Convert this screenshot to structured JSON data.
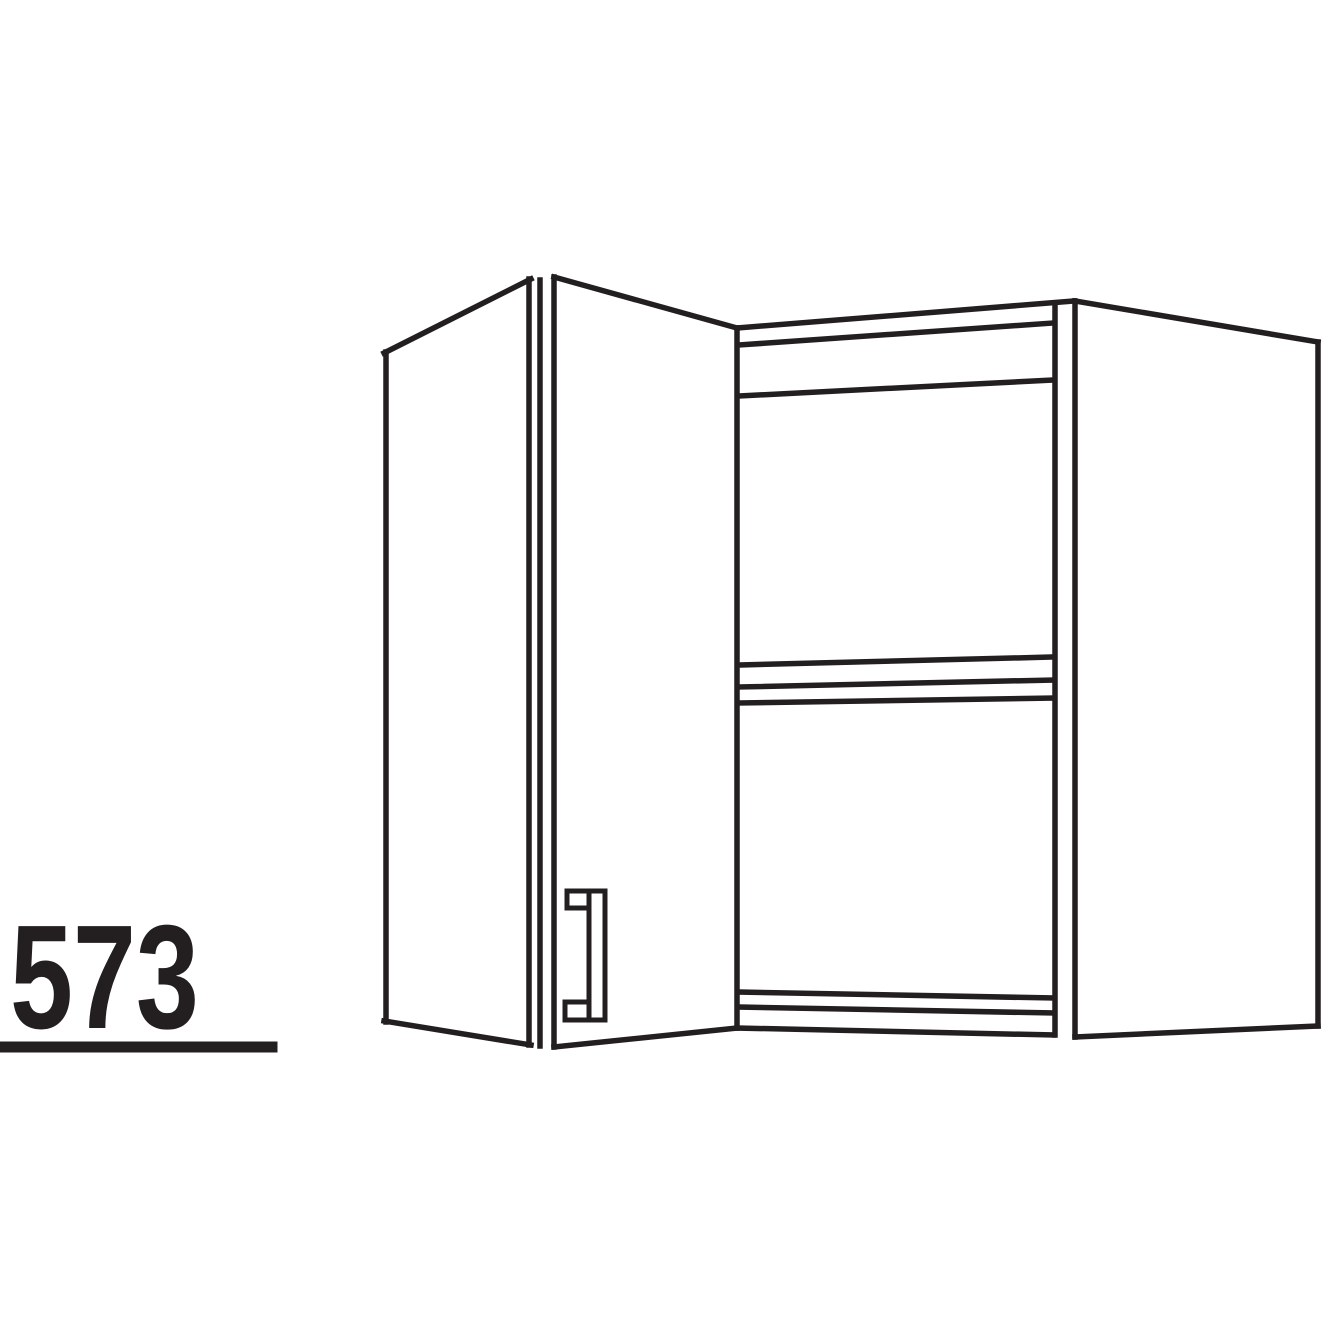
{
  "figure": {
    "label": "573"
  },
  "colors": {
    "ink": "#231f20",
    "background": "#ffffff"
  },
  "drawing": {
    "stroke_width": 5.5,
    "handle_stroke_width": 5,
    "lines": [
      {
        "name": "door-left-edge",
        "x1": 386,
        "y1": 352,
        "x2": 386,
        "y2": 1022
      },
      {
        "name": "door-top-edge",
        "x1": 384,
        "y1": 353,
        "x2": 531,
        "y2": 279
      },
      {
        "name": "door-bottom-edge",
        "x1": 384,
        "y1": 1021,
        "x2": 531,
        "y2": 1045
      },
      {
        "name": "door-right-edge",
        "x1": 529,
        "y1": 279,
        "x2": 529,
        "y2": 1045
      },
      {
        "name": "corner-stile-front-edge",
        "x1": 540,
        "y1": 280,
        "x2": 540,
        "y2": 1046
      },
      {
        "name": "corner-stile-back-edge",
        "x1": 554,
        "y1": 277,
        "x2": 554,
        "y2": 1047
      },
      {
        "name": "corner-top-edge",
        "x1": 554,
        "y1": 277,
        "x2": 737,
        "y2": 328
      },
      {
        "name": "corner-bottom-edge",
        "x1": 554,
        "y1": 1047,
        "x2": 737,
        "y2": 1028
      },
      {
        "name": "opening-left-stile",
        "x1": 737,
        "y1": 328,
        "x2": 737,
        "y2": 1028
      },
      {
        "name": "top-panel-outer-edge",
        "x1": 737,
        "y1": 328,
        "x2": 1074,
        "y2": 301
      },
      {
        "name": "top-panel-inner-edge",
        "x1": 739,
        "y1": 345,
        "x2": 1053,
        "y2": 323
      },
      {
        "name": "top-panel-underside-edge",
        "x1": 739,
        "y1": 396,
        "x2": 1053,
        "y2": 380
      },
      {
        "name": "shelf-top-edge",
        "x1": 739,
        "y1": 665,
        "x2": 1053,
        "y2": 657
      },
      {
        "name": "shelf-front-edge",
        "x1": 739,
        "y1": 687,
        "x2": 1053,
        "y2": 680
      },
      {
        "name": "shelf-bottom-edge",
        "x1": 739,
        "y1": 703,
        "x2": 1053,
        "y2": 698
      },
      {
        "name": "bottom-panel-top-edge",
        "x1": 739,
        "y1": 992,
        "x2": 1053,
        "y2": 998
      },
      {
        "name": "bottom-panel-front-edge",
        "x1": 739,
        "y1": 1007,
        "x2": 1053,
        "y2": 1013
      },
      {
        "name": "opening-bottom-edge",
        "x1": 737,
        "y1": 1028,
        "x2": 1053,
        "y2": 1035
      },
      {
        "name": "opening-right-stile",
        "x1": 1055,
        "y1": 303,
        "x2": 1055,
        "y2": 1035
      },
      {
        "name": "side-panel-front-edge",
        "x1": 1075,
        "y1": 301,
        "x2": 1075,
        "y2": 1037
      },
      {
        "name": "side-panel-top-edge",
        "x1": 1075,
        "y1": 301,
        "x2": 1318,
        "y2": 342
      },
      {
        "name": "side-panel-right-edge",
        "x1": 1318,
        "y1": 342,
        "x2": 1318,
        "y2": 1026
      },
      {
        "name": "side-panel-bottom-edge",
        "x1": 1318,
        "y1": 1026,
        "x2": 1075,
        "y2": 1037
      },
      {
        "name": "label-underline",
        "x1": 5,
        "y1": 1047,
        "x2": 272,
        "y2": 1047,
        "w": 11,
        "cap": "round"
      }
    ],
    "handle": [
      {
        "name": "handle-top-foot",
        "x": 567,
        "y": 891,
        "w": 38,
        "h": 17
      },
      {
        "name": "handle-bottom-foot",
        "x": 565,
        "y": 1002,
        "w": 40,
        "h": 18
      },
      {
        "name": "handle-bar",
        "x": 589,
        "y": 891,
        "w": 16,
        "h": 129
      }
    ]
  }
}
